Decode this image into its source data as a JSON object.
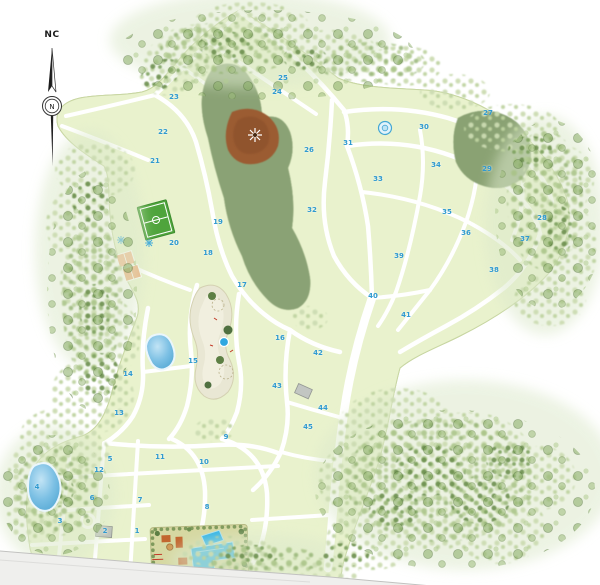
{
  "compass": {
    "label": "NC",
    "cardinal": "N"
  },
  "zones": [
    {
      "n": "1",
      "x": 137,
      "y": 531
    },
    {
      "n": "2",
      "x": 105,
      "y": 531
    },
    {
      "n": "3",
      "x": 60,
      "y": 521
    },
    {
      "n": "4",
      "x": 37,
      "y": 487
    },
    {
      "n": "5",
      "x": 110,
      "y": 459
    },
    {
      "n": "6",
      "x": 92,
      "y": 498
    },
    {
      "n": "7",
      "x": 140,
      "y": 500
    },
    {
      "n": "8",
      "x": 207,
      "y": 507
    },
    {
      "n": "9",
      "x": 226,
      "y": 437
    },
    {
      "n": "10",
      "x": 204,
      "y": 462
    },
    {
      "n": "11",
      "x": 160,
      "y": 457
    },
    {
      "n": "12",
      "x": 99,
      "y": 470
    },
    {
      "n": "13",
      "x": 119,
      "y": 413
    },
    {
      "n": "14",
      "x": 128,
      "y": 374
    },
    {
      "n": "15",
      "x": 193,
      "y": 361
    },
    {
      "n": "16",
      "x": 280,
      "y": 338
    },
    {
      "n": "17",
      "x": 242,
      "y": 285
    },
    {
      "n": "18",
      "x": 208,
      "y": 253
    },
    {
      "n": "19",
      "x": 218,
      "y": 222
    },
    {
      "n": "20",
      "x": 174,
      "y": 243
    },
    {
      "n": "21",
      "x": 155,
      "y": 161
    },
    {
      "n": "22",
      "x": 163,
      "y": 132
    },
    {
      "n": "23",
      "x": 174,
      "y": 97
    },
    {
      "n": "24",
      "x": 277,
      "y": 92
    },
    {
      "n": "25",
      "x": 283,
      "y": 78
    },
    {
      "n": "26",
      "x": 309,
      "y": 150
    },
    {
      "n": "27",
      "x": 488,
      "y": 113
    },
    {
      "n": "28",
      "x": 542,
      "y": 218
    },
    {
      "n": "29",
      "x": 487,
      "y": 169
    },
    {
      "n": "30",
      "x": 424,
      "y": 127
    },
    {
      "n": "31",
      "x": 348,
      "y": 143
    },
    {
      "n": "32",
      "x": 312,
      "y": 210
    },
    {
      "n": "33",
      "x": 378,
      "y": 179
    },
    {
      "n": "34",
      "x": 436,
      "y": 165
    },
    {
      "n": "35",
      "x": 447,
      "y": 212
    },
    {
      "n": "36",
      "x": 466,
      "y": 233
    },
    {
      "n": "37",
      "x": 525,
      "y": 239
    },
    {
      "n": "38",
      "x": 494,
      "y": 270
    },
    {
      "n": "39",
      "x": 399,
      "y": 256
    },
    {
      "n": "40",
      "x": 373,
      "y": 296
    },
    {
      "n": "41",
      "x": 406,
      "y": 315
    },
    {
      "n": "42",
      "x": 318,
      "y": 353
    },
    {
      "n": "43",
      "x": 277,
      "y": 386
    },
    {
      "n": "44",
      "x": 323,
      "y": 408
    },
    {
      "n": "45",
      "x": 308,
      "y": 427
    }
  ],
  "features": [
    "north-arrow",
    "forest-reserve",
    "clearing-lookout",
    "soccer-field",
    "sport-courts",
    "fountain-icons",
    "central-park",
    "park-fountain",
    "pond",
    "lake",
    "roundabout",
    "clubhouse-pools",
    "gray-buildings",
    "tree-scatter",
    "road-network",
    "board-edge"
  ],
  "colors": {
    "parcel": "#e9f2cd",
    "road": "#ffffff",
    "forest_dark": "#5e7c49",
    "clearing_brown": "#9b5c33",
    "water": "#2fb3e8",
    "zone_label": "#2f9ad0",
    "field_green": "#4fa43c",
    "court_orange": "#f3b184",
    "park_beige": "#e9e7d4",
    "club_ground": "#d6d8a2"
  }
}
